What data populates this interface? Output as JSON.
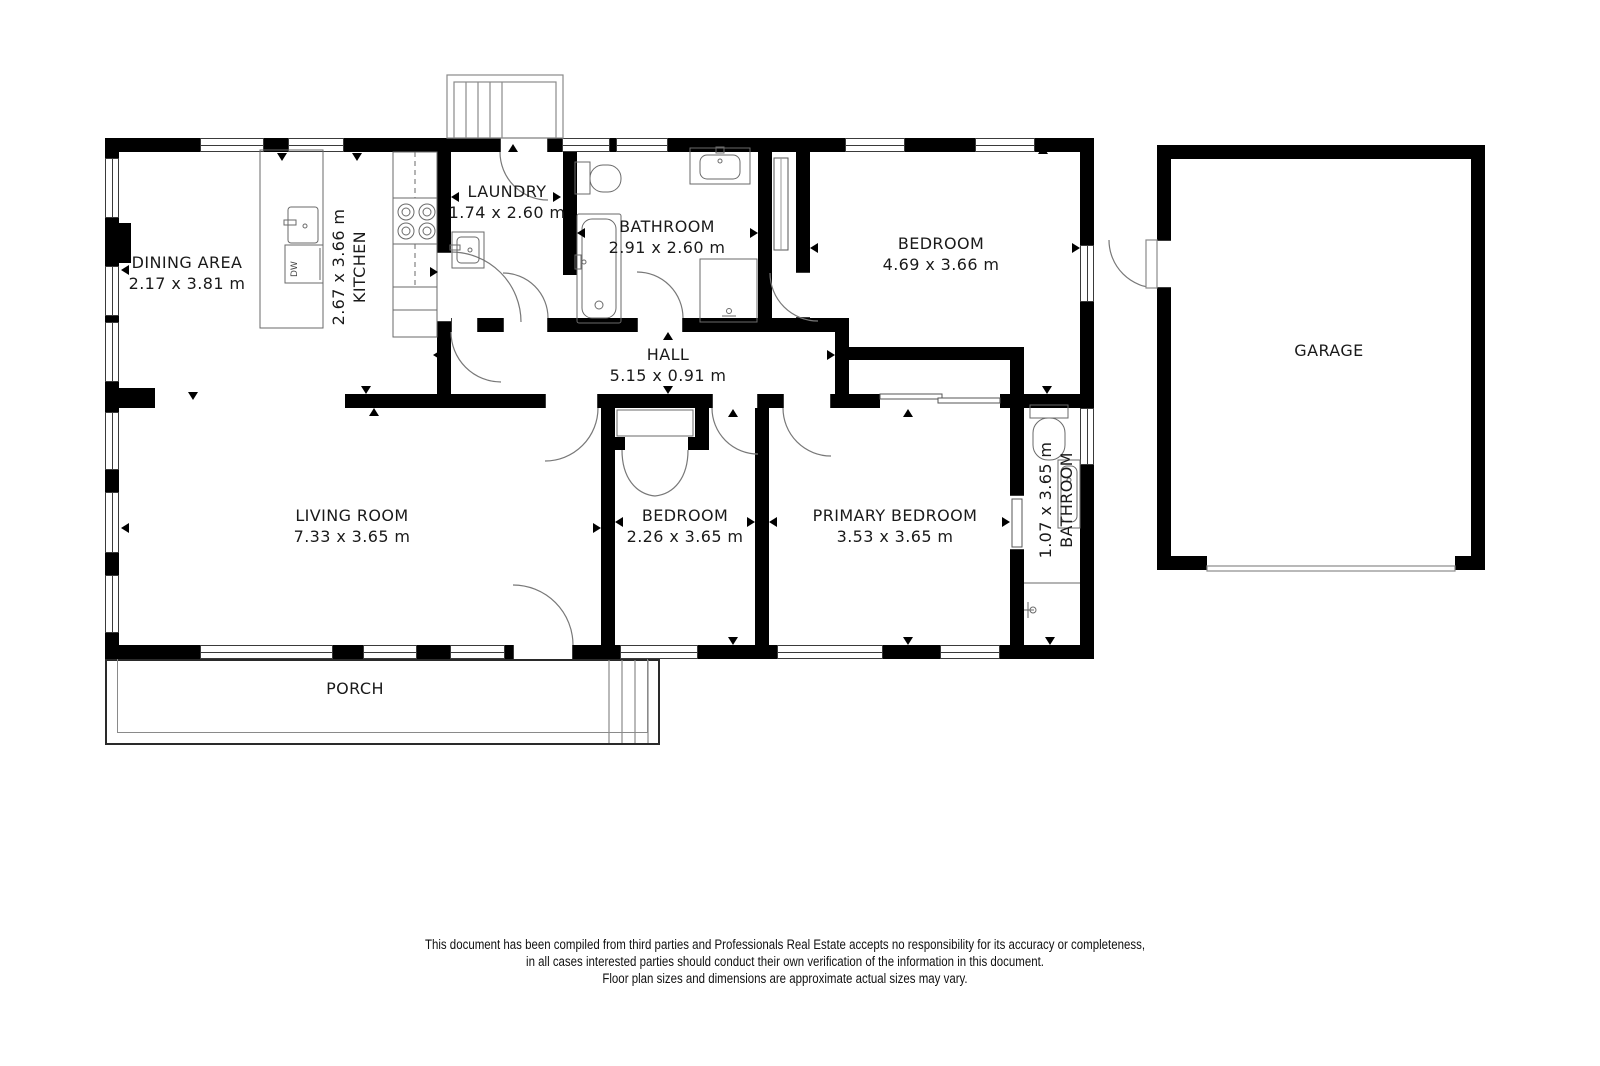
{
  "rooms": [
    {
      "name": "DINING AREA",
      "dims": "2.17 x 3.81 m"
    },
    {
      "name": "KITCHEN",
      "dims": "2.67 x 3.66 m"
    },
    {
      "name": "LAUNDRY",
      "dims": "1.74 x 2.60 m"
    },
    {
      "name": "BATHROOM",
      "dims": "2.91 x 2.60 m"
    },
    {
      "name": "BEDROOM",
      "dims": "4.69 x 3.66 m"
    },
    {
      "name": "HALL",
      "dims": "5.15 x 0.91 m"
    },
    {
      "name": "LIVING ROOM",
      "dims": "7.33 x 3.65 m"
    },
    {
      "name": "BEDROOM",
      "dims": "2.26 x 3.65 m"
    },
    {
      "name": "PRIMARY BEDROOM",
      "dims": "3.53 x 3.65 m"
    },
    {
      "name": "BATHROOM",
      "dims": "1.07 x 3.65 m"
    },
    {
      "name": "GARAGE",
      "dims": ""
    },
    {
      "name": "PORCH",
      "dims": ""
    }
  ],
  "fixtures": {
    "dishwasher_label": "DW"
  },
  "disclaimer": {
    "line1": "This document has been compiled from third parties and Professionals Real Estate accepts no responsibility for its accuracy or completeness,",
    "line2": "in all cases interested parties should conduct their own verification of the information in this document.",
    "line3": "Floor plan sizes and dimensions are approximate actual sizes may vary."
  },
  "colors": {
    "wall": "#000000",
    "fixture_line": "#6a6a6a",
    "text": "#1a1a1a"
  }
}
